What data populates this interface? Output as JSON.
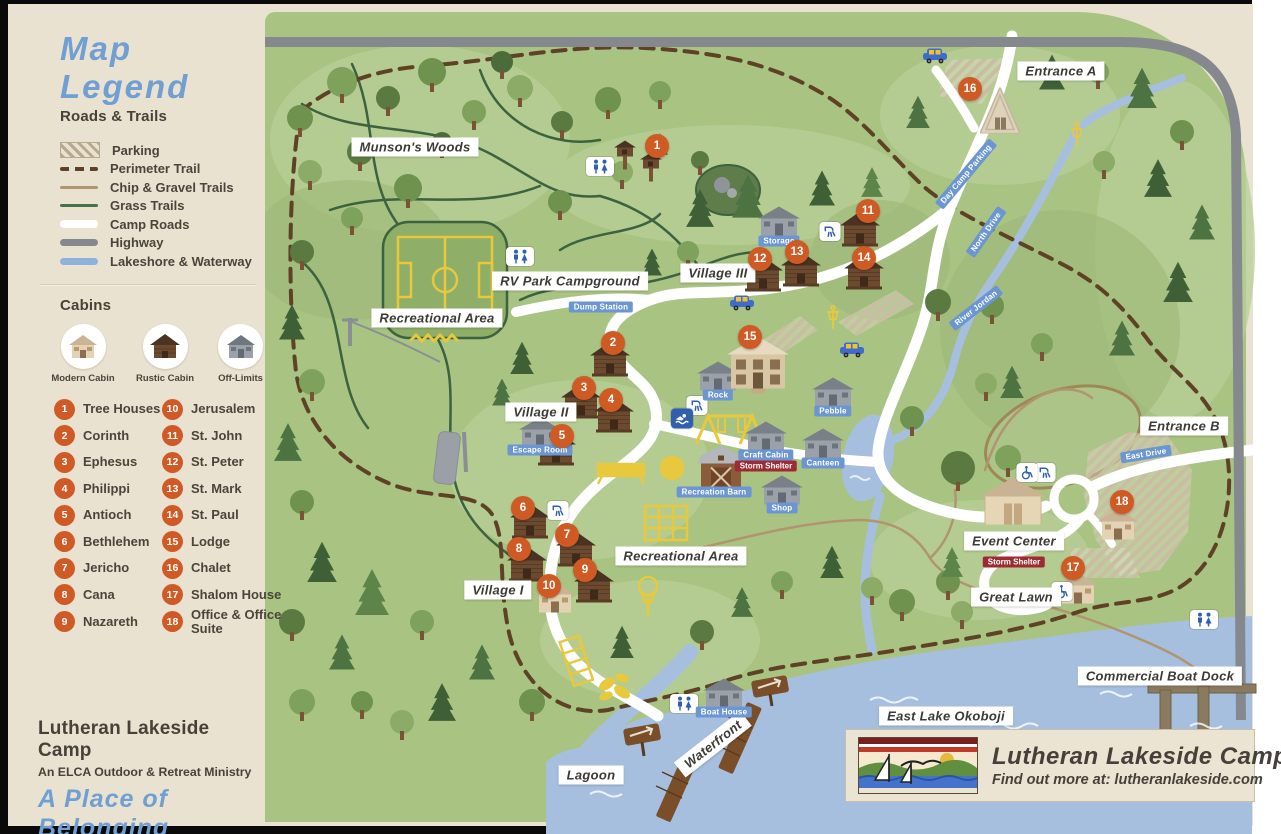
{
  "legend": {
    "title": "Map Legend",
    "roads_heading": "Roads & Trails",
    "road_items": [
      {
        "label": "Parking",
        "swatch": "parking"
      },
      {
        "label": "Perimeter Trail",
        "swatch": "perimeter"
      },
      {
        "label": "Chip & Gravel Trails",
        "swatch": "chip"
      },
      {
        "label": "Grass Trails",
        "swatch": "grass"
      },
      {
        "label": "Camp Roads",
        "swatch": "road"
      },
      {
        "label": "Highway",
        "swatch": "highway"
      },
      {
        "label": "Lakeshore & Waterway",
        "swatch": "water"
      }
    ],
    "cabins_heading": "Cabins",
    "cabin_types": [
      {
        "label": "Modern Cabin",
        "type": "modern"
      },
      {
        "label": "Rustic Cabin",
        "type": "rustic"
      },
      {
        "label": "Off-Limits",
        "type": "offlimits"
      }
    ],
    "cabins": [
      {
        "num": 1,
        "name": "Tree Houses"
      },
      {
        "num": 2,
        "name": "Corinth"
      },
      {
        "num": 3,
        "name": "Ephesus"
      },
      {
        "num": 4,
        "name": "Philippi"
      },
      {
        "num": 5,
        "name": "Antioch"
      },
      {
        "num": 6,
        "name": "Bethlehem"
      },
      {
        "num": 7,
        "name": "Jericho"
      },
      {
        "num": 8,
        "name": "Cana"
      },
      {
        "num": 9,
        "name": "Nazareth"
      },
      {
        "num": 10,
        "name": "Jerusalem"
      },
      {
        "num": 11,
        "name": "St. John"
      },
      {
        "num": 12,
        "name": "St. Peter"
      },
      {
        "num": 13,
        "name": "St. Mark"
      },
      {
        "num": 14,
        "name": "St. Paul"
      },
      {
        "num": 15,
        "name": "Lodge"
      },
      {
        "num": 16,
        "name": "Chalet"
      },
      {
        "num": 17,
        "name": "Shalom House"
      },
      {
        "num": 18,
        "name": "Office & Office Suite"
      }
    ]
  },
  "footer": {
    "org": "Lutheran Lakeside Camp",
    "sub": "An ELCA Outdoor & Retreat Ministry",
    "tagline": "A Place of Belonging"
  },
  "logo": {
    "title": "Lutheran Lakeside Camp",
    "subtitle": "Find out more at: lutheranlakeside.com"
  },
  "map": {
    "area_labels": [
      {
        "text": "Munson's Woods",
        "x": 415,
        "y": 147
      },
      {
        "text": "Entrance A",
        "x": 1061,
        "y": 71
      },
      {
        "text": "RV Park Campground",
        "x": 570,
        "y": 281
      },
      {
        "text": "Village III",
        "x": 718,
        "y": 273
      },
      {
        "text": "Recreational Area",
        "x": 437,
        "y": 318
      },
      {
        "text": "Village II",
        "x": 541,
        "y": 412
      },
      {
        "text": "Recreational Area",
        "x": 681,
        "y": 556
      },
      {
        "text": "Village I",
        "x": 498,
        "y": 590
      },
      {
        "text": "Entrance B",
        "x": 1184,
        "y": 426
      },
      {
        "text": "Event Center",
        "x": 1014,
        "y": 541
      },
      {
        "text": "Great Lawn",
        "x": 1016,
        "y": 597
      },
      {
        "text": "Commercial Boat Dock",
        "x": 1160,
        "y": 676
      },
      {
        "text": "East Lake Okoboji",
        "x": 946,
        "y": 716
      },
      {
        "text": "Lagoon",
        "x": 591,
        "y": 775
      },
      {
        "text": "Waterfront",
        "x": 713,
        "y": 744,
        "rot": -38
      }
    ],
    "facility_labels": [
      {
        "text": "Dump Station",
        "x": 601,
        "y": 307
      },
      {
        "text": "Storage",
        "x": 779,
        "y": 241
      },
      {
        "text": "Escape Room",
        "x": 540,
        "y": 450
      },
      {
        "text": "Rock",
        "x": 718,
        "y": 395
      },
      {
        "text": "Pebble",
        "x": 833,
        "y": 411
      },
      {
        "text": "Craft Cabin",
        "x": 766,
        "y": 455
      },
      {
        "text": "Canteen",
        "x": 823,
        "y": 463
      },
      {
        "text": "Recreation Barn",
        "x": 714,
        "y": 492
      },
      {
        "text": "Shop",
        "x": 782,
        "y": 508
      },
      {
        "text": "Boat House",
        "x": 724,
        "y": 712
      },
      {
        "text": "East Drive",
        "x": 1146,
        "y": 454,
        "rot": -9
      },
      {
        "text": "North Drive",
        "x": 986,
        "y": 232,
        "rot": -55
      },
      {
        "text": "River Jordan",
        "x": 976,
        "y": 308,
        "rot": -38
      },
      {
        "text": "Day Camp Parking",
        "x": 966,
        "y": 174,
        "rot": -50
      }
    ],
    "warning_labels": [
      {
        "text": "Storm Shelter",
        "x": 766,
        "y": 466
      },
      {
        "text": "Storm Shelter",
        "x": 1014,
        "y": 562
      }
    ],
    "markers": [
      {
        "num": 1,
        "name": "Tree Houses",
        "x": 657,
        "y": 146
      },
      {
        "num": 2,
        "name": "Corinth",
        "x": 613,
        "y": 343
      },
      {
        "num": 3,
        "name": "Ephesus",
        "x": 584,
        "y": 388
      },
      {
        "num": 4,
        "name": "Philippi",
        "x": 611,
        "y": 400
      },
      {
        "num": 5,
        "name": "Antioch",
        "x": 562,
        "y": 436
      },
      {
        "num": 6,
        "name": "Bethlehem",
        "x": 523,
        "y": 508
      },
      {
        "num": 7,
        "name": "Jericho",
        "x": 567,
        "y": 535
      },
      {
        "num": 8,
        "name": "Cana",
        "x": 519,
        "y": 549
      },
      {
        "num": 9,
        "name": "Nazareth",
        "x": 585,
        "y": 570
      },
      {
        "num": 10,
        "name": "Jerusalem",
        "x": 549,
        "y": 586
      },
      {
        "num": 11,
        "name": "St. John",
        "x": 868,
        "y": 211
      },
      {
        "num": 12,
        "name": "St. Peter",
        "x": 760,
        "y": 259
      },
      {
        "num": 13,
        "name": "St. Mark",
        "x": 797,
        "y": 252
      },
      {
        "num": 14,
        "name": "St. Paul",
        "x": 864,
        "y": 258
      },
      {
        "num": 15,
        "name": "Lodge",
        "x": 750,
        "y": 337
      },
      {
        "num": 16,
        "name": "Chalet",
        "x": 970,
        "y": 89
      },
      {
        "num": 17,
        "name": "Shalom House",
        "x": 1073,
        "y": 568
      },
      {
        "num": 18,
        "name": "Office & Office Suite",
        "x": 1122,
        "y": 502
      }
    ],
    "icons": [
      {
        "name": "restroom-icon",
        "x": 600,
        "y": 168
      },
      {
        "name": "restroom-icon",
        "x": 520,
        "y": 258
      },
      {
        "name": "restroom-icon",
        "x": 684,
        "y": 705
      },
      {
        "name": "restroom-icon",
        "x": 1204,
        "y": 621
      },
      {
        "name": "shower-icon",
        "x": 830,
        "y": 233
      },
      {
        "name": "shower-icon",
        "x": 697,
        "y": 407
      },
      {
        "name": "shower-icon",
        "x": 558,
        "y": 512
      },
      {
        "name": "shower-icon",
        "x": 1045,
        "y": 474
      },
      {
        "name": "swim-icon",
        "x": 682,
        "y": 420
      },
      {
        "name": "accessible-icon",
        "x": 1027,
        "y": 474
      },
      {
        "name": "accessible-icon",
        "x": 1062,
        "y": 593
      },
      {
        "name": "car-icon",
        "x": 935,
        "y": 58
      },
      {
        "name": "car-icon",
        "x": 742,
        "y": 305
      },
      {
        "name": "car-icon",
        "x": 852,
        "y": 352
      },
      {
        "name": "disc-golf-icon",
        "x": 1077,
        "y": 137
      },
      {
        "name": "disc-golf-icon",
        "x": 833,
        "y": 320
      }
    ],
    "buildings": [
      {
        "name": "chalet-building",
        "type": "aframe",
        "x": 1000,
        "y": 113
      },
      {
        "name": "storage-building",
        "type": "offlimits",
        "x": 779,
        "y": 225
      },
      {
        "name": "cabin-st-john",
        "type": "rustic",
        "x": 860,
        "y": 232
      },
      {
        "name": "cabin-st-peter",
        "type": "rustic",
        "x": 763,
        "y": 277
      },
      {
        "name": "cabin-st-mark",
        "type": "rustic",
        "x": 801,
        "y": 272
      },
      {
        "name": "cabin-st-paul",
        "type": "rustic",
        "x": 864,
        "y": 275
      },
      {
        "name": "cabin-corinth",
        "type": "rustic",
        "x": 610,
        "y": 362
      },
      {
        "name": "cabin-ephesus",
        "type": "rustic",
        "x": 581,
        "y": 404
      },
      {
        "name": "cabin-philippi",
        "type": "rustic",
        "x": 614,
        "y": 418
      },
      {
        "name": "cabin-antioch",
        "type": "rustic",
        "x": 556,
        "y": 451
      },
      {
        "name": "escape-room-building",
        "type": "offlimits",
        "x": 540,
        "y": 436
      },
      {
        "name": "rock-building",
        "type": "offlimits",
        "x": 718,
        "y": 380
      },
      {
        "name": "lodge-building",
        "type": "lodge",
        "x": 758,
        "y": 368
      },
      {
        "name": "pebble-building",
        "type": "offlimits",
        "x": 833,
        "y": 396
      },
      {
        "name": "canteen-building",
        "type": "offlimits",
        "x": 823,
        "y": 447
      },
      {
        "name": "craft-cabin-building",
        "type": "offlimits",
        "x": 766,
        "y": 440
      },
      {
        "name": "recreation-barn-building",
        "type": "barn",
        "x": 721,
        "y": 470
      },
      {
        "name": "shop-building",
        "type": "offlimits",
        "x": 782,
        "y": 494
      },
      {
        "name": "cabin-bethlehem",
        "type": "rustic",
        "x": 530,
        "y": 524
      },
      {
        "name": "cabin-jericho",
        "type": "rustic",
        "x": 576,
        "y": 552
      },
      {
        "name": "cabin-cana",
        "type": "rustic",
        "x": 527,
        "y": 567
      },
      {
        "name": "cabin-nazareth",
        "type": "rustic",
        "x": 594,
        "y": 588
      },
      {
        "name": "cabin-jerusalem",
        "type": "modern",
        "x": 555,
        "y": 601
      },
      {
        "name": "event-center-building",
        "type": "event",
        "x": 1013,
        "y": 506
      },
      {
        "name": "office-suite-building",
        "type": "modern",
        "x": 1118,
        "y": 528
      },
      {
        "name": "shalom-house-building",
        "type": "modern",
        "x": 1078,
        "y": 592
      },
      {
        "name": "boat-house-building",
        "type": "offlimits",
        "x": 724,
        "y": 697
      },
      {
        "name": "tree-house-1",
        "type": "treehouse",
        "x": 625,
        "y": 158
      },
      {
        "name": "tree-house-2",
        "type": "treehouse",
        "x": 651,
        "y": 170
      }
    ]
  },
  "colors": {
    "paper": "#eae2d0",
    "map_green": "#a9c383",
    "water": "#a6bfdf",
    "marker_orange": "#d05a24",
    "pill_blue": "#6b96d2",
    "warn_red": "#9c2b33",
    "legend_blue": "#6f9fd3",
    "highway_grey": "#85898e",
    "trail_brown": "#5f4126",
    "road_white": "#ffffff",
    "accent_yellow": "#e8c83c"
  }
}
